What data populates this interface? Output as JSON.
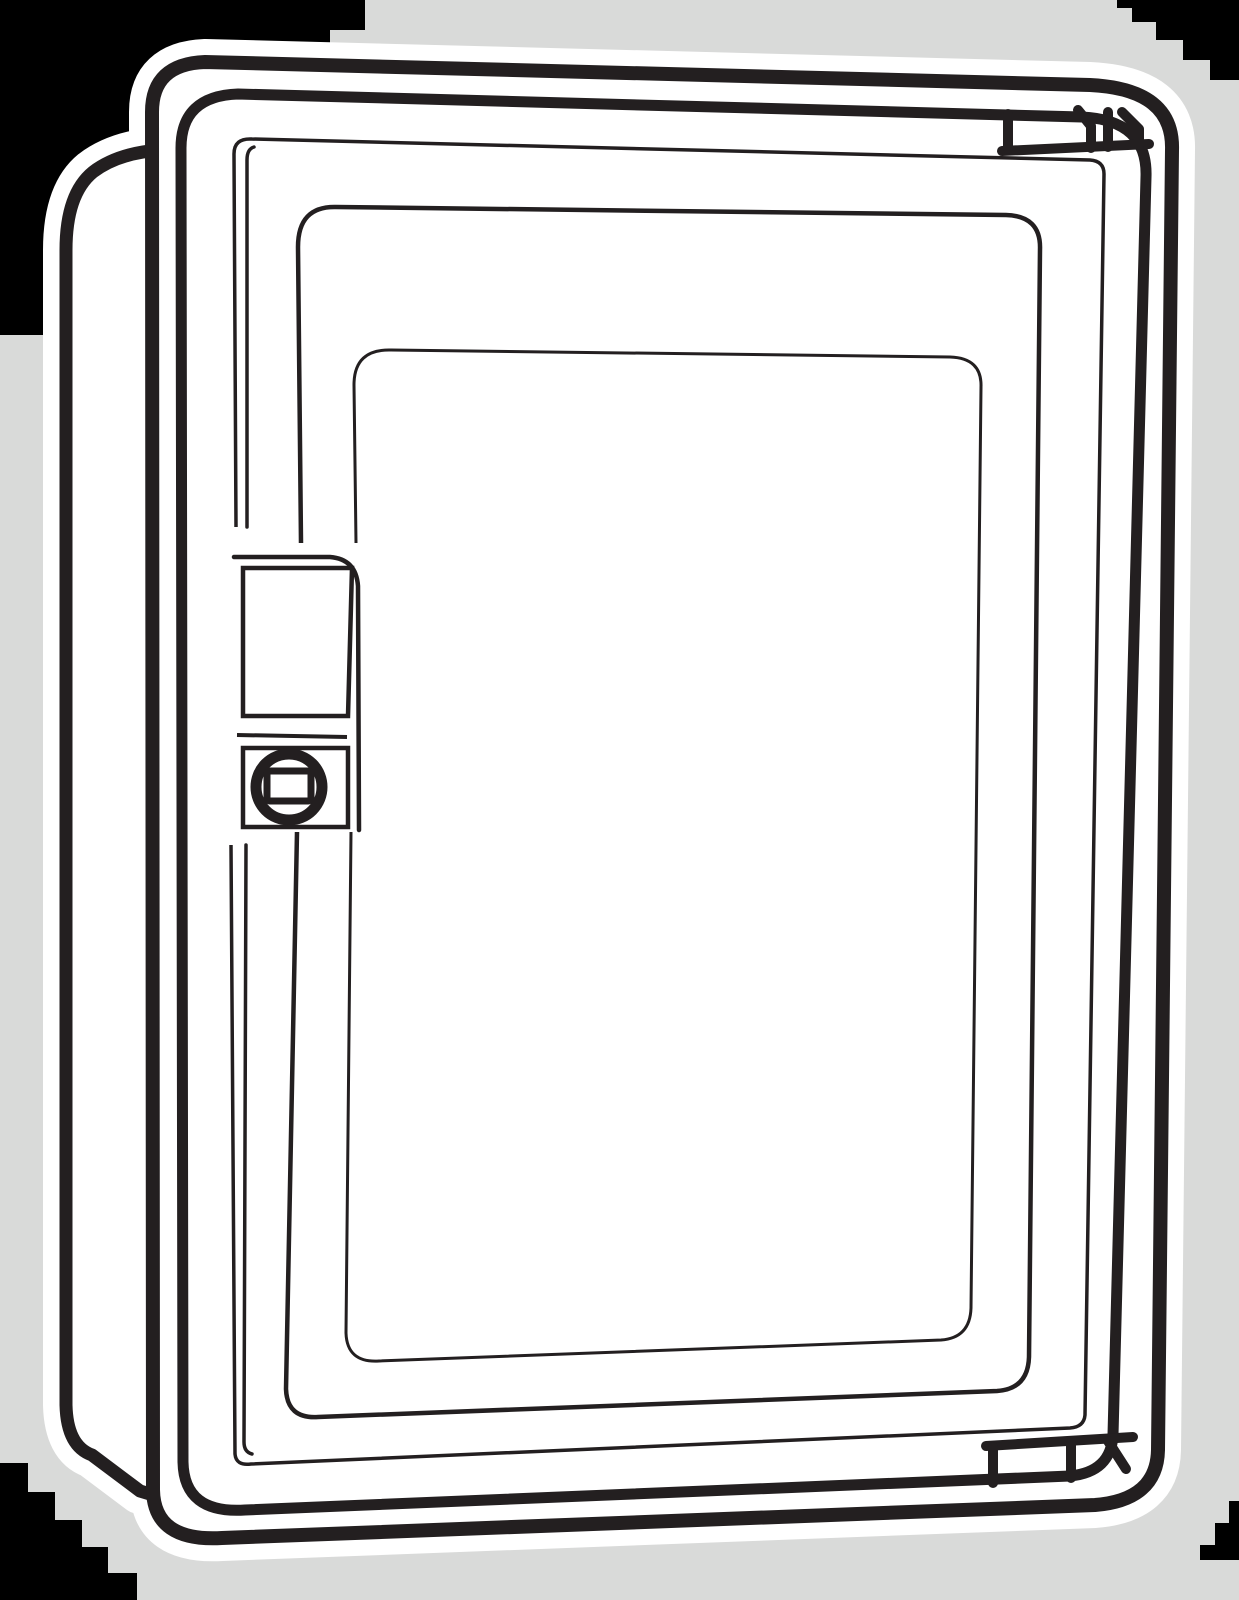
{
  "figure": {
    "type": "technical-line-illustration",
    "title": "Surface-mounted electrical enclosure with transparent window door",
    "description": "Black-and-white vector line drawing of a wall-mount electrical enclosure cabinet shown in three-quarter perspective: a deep side panel on the left, a front frame, a hinged door with a large transparent viewing window, a recessed latch plate with a round quarter-turn lock on the left edge of the door, and two hinge knuckles on the right edge (top and bottom). The drawing sits on a light gray backdrop with stair-stepped black page corners and a white halo outline around the artwork.",
    "parts": [
      {
        "name": "side-panel",
        "label": "Enclosure side panel (left depth face)"
      },
      {
        "name": "outer-frame",
        "label": "Enclosure front frame"
      },
      {
        "name": "door",
        "label": "Hinged door"
      },
      {
        "name": "door-molding",
        "label": "Recessed molding channel around window"
      },
      {
        "name": "window-outer",
        "label": "Window outer frame"
      },
      {
        "name": "window-inner",
        "label": "Transparent window pane"
      },
      {
        "name": "latch-plate",
        "label": "Latch plate recess"
      },
      {
        "name": "lock",
        "label": "Quarter-turn lock with square driver"
      },
      {
        "name": "top-hinge",
        "label": "Top hinge knuckles"
      },
      {
        "name": "bottom-hinge",
        "label": "Bottom hinge knuckles"
      }
    ]
  },
  "colors": {
    "canvas_corner": "#000000",
    "backdrop": "#d9dad9",
    "paper": "#ffffff",
    "line": "#231f20"
  }
}
